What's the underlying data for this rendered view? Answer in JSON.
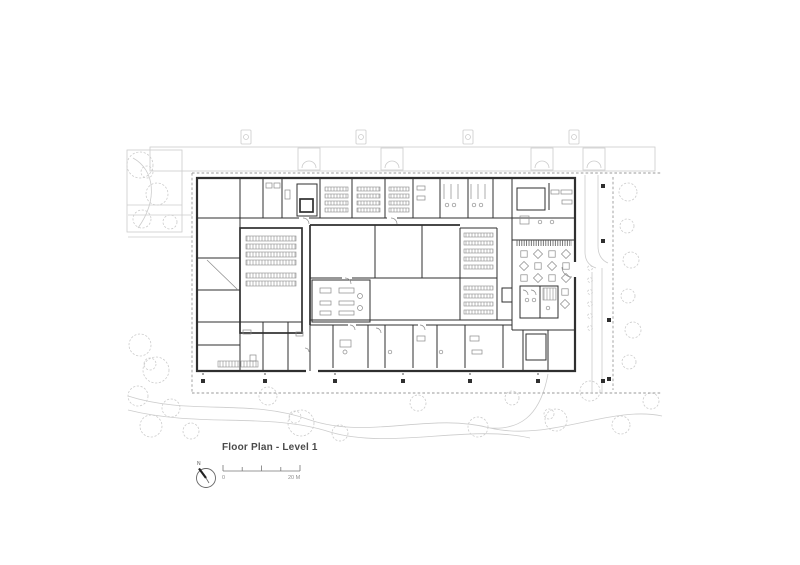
{
  "title": "Floor Plan - Level 1",
  "north": {
    "label": "N"
  },
  "scale_bar": {
    "start_label": "0",
    "end_label": "20 M"
  },
  "colors": {
    "paper": "#ffffff",
    "wall": "#2f2f2f",
    "furniture": "#8a8a8a",
    "site": "#cccccc",
    "boundary": "#9a9a9a",
    "text": "#4a4a4a"
  }
}
